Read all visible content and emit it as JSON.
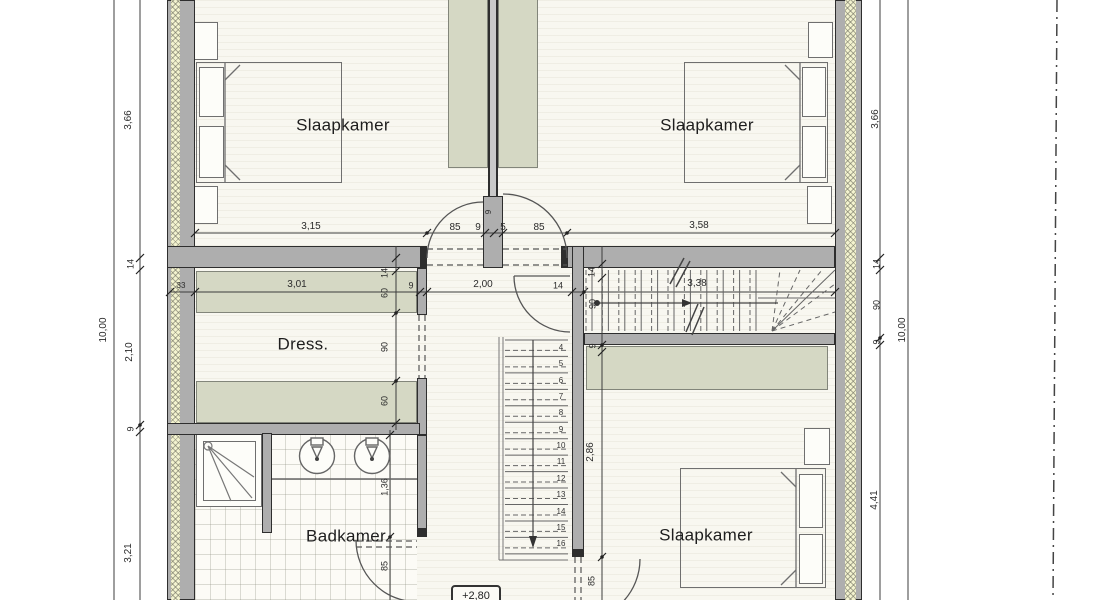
{
  "rooms": {
    "bedroom_top_left": "Slaapkamer",
    "bedroom_top_right": "Slaapkamer",
    "bedroom_bottom_right": "Slaapkamer",
    "dressing": "Dress.",
    "bathroom": "Badkamer"
  },
  "level_marker": "+2,80",
  "stair_numbers": [
    "4",
    "5",
    "6",
    "7",
    "8",
    "9",
    "10",
    "11",
    "12",
    "13",
    "14",
    "15",
    "16"
  ],
  "dimensions": [
    {
      "t": "3,15",
      "x": 311,
      "y": 227
    },
    {
      "t": "85",
      "x": 455,
      "y": 228
    },
    {
      "t": "9",
      "x": 478,
      "y": 228
    },
    {
      "t": "9",
      "x": 489,
      "y": 212,
      "r": -90,
      "s": 8
    },
    {
      "t": "5",
      "x": 503,
      "y": 228
    },
    {
      "t": "85",
      "x": 539,
      "y": 228
    },
    {
      "t": "3,58",
      "x": 699,
      "y": 226
    },
    {
      "t": "33",
      "x": 181,
      "y": 286,
      "s": 8
    },
    {
      "t": "3,01",
      "x": 297,
      "y": 285
    },
    {
      "t": "9",
      "x": 411,
      "y": 286,
      "s": 9
    },
    {
      "t": "2,00",
      "x": 483,
      "y": 285
    },
    {
      "t": "14",
      "x": 558,
      "y": 286,
      "s": 9
    },
    {
      "t": "3,38",
      "x": 697,
      "y": 284
    },
    {
      "t": "10,00",
      "x": 104,
      "y": 330,
      "r": -90
    },
    {
      "t": "3,66",
      "x": 129,
      "y": 120,
      "r": -90
    },
    {
      "t": "14",
      "x": 131,
      "y": 264,
      "r": -90,
      "s": 9
    },
    {
      "t": "2,10",
      "x": 130,
      "y": 352,
      "r": -90
    },
    {
      "t": "9",
      "x": 131,
      "y": 429,
      "r": -90,
      "s": 9
    },
    {
      "t": "3,21",
      "x": 129,
      "y": 553,
      "r": -90
    },
    {
      "t": "3,66",
      "x": 876,
      "y": 119,
      "r": -90
    },
    {
      "t": "14",
      "x": 877,
      "y": 264,
      "r": -90,
      "s": 9
    },
    {
      "t": "90",
      "x": 877,
      "y": 305,
      "r": -90,
      "s": 9
    },
    {
      "t": "9",
      "x": 877,
      "y": 342,
      "r": -90,
      "s": 9
    },
    {
      "t": "4,41",
      "x": 875,
      "y": 500,
      "r": -90
    },
    {
      "t": "10,00",
      "x": 903,
      "y": 330,
      "r": -90
    },
    {
      "t": "14",
      "x": 385,
      "y": 273,
      "r": -90,
      "s": 9
    },
    {
      "t": "60",
      "x": 385,
      "y": 293,
      "r": -90,
      "s": 9
    },
    {
      "t": "90",
      "x": 385,
      "y": 347,
      "r": -90,
      "s": 9
    },
    {
      "t": "60",
      "x": 385,
      "y": 401,
      "r": -90,
      "s": 9
    },
    {
      "t": "14",
      "x": 592,
      "y": 272,
      "r": -90,
      "s": 9
    },
    {
      "t": "90",
      "x": 593,
      "y": 304,
      "r": -90,
      "s": 9
    },
    {
      "t": "9",
      "x": 593,
      "y": 346,
      "r": -90,
      "s": 9
    },
    {
      "t": "2,86",
      "x": 591,
      "y": 452,
      "r": -90
    },
    {
      "t": "85",
      "x": 592,
      "y": 581,
      "r": -90,
      "s": 9
    },
    {
      "t": "1,36",
      "x": 385,
      "y": 487,
      "r": -90,
      "s": 9
    },
    {
      "t": "85",
      "x": 385,
      "y": 566,
      "r": -90,
      "s": 9
    }
  ],
  "colors": {
    "wall_fill": "#aeaeae",
    "wall_line": "#2e2e2e",
    "insulation": "#f3f3cf",
    "wardrobe": "#d5d8c4",
    "floor": "#f8f7f0",
    "dimension_text": "#2b2b2b"
  }
}
